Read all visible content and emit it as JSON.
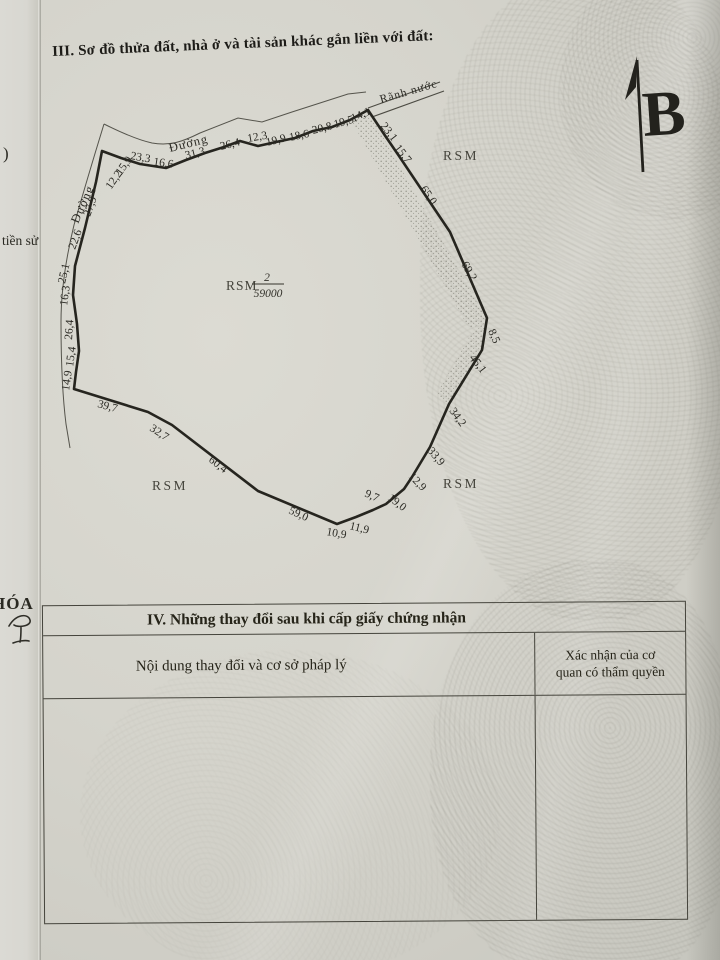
{
  "colors": {
    "paper": "#d5d4cc",
    "ink": "#23221d"
  },
  "section3": {
    "title": "III. Sơ đồ thửa đất, nhà ở và tài sản khác gắn liền với đất:"
  },
  "margin": {
    "fragment_top": ")",
    "fragment_mid": "tiền sử",
    "fragment_bottom": "HÓA"
  },
  "diagram": {
    "north_label": "B",
    "top_road_label": "Đường",
    "left_road_label": "Đường",
    "ditch_label": "Rãnh nước",
    "parcel": {
      "code": "RSM",
      "numerator": "2",
      "denominator": "59000"
    },
    "adjacent_labels": {
      "top_right": "RSM",
      "bottom_left": "RSM",
      "bottom_right": "RSM"
    },
    "measurements": {
      "top": [
        "12,2",
        "15,9",
        "23,3",
        "16,6",
        "31,3",
        "26,4",
        "12,3",
        "19,9",
        "18,6",
        "20,8",
        "19,5",
        "14,1"
      ],
      "right": [
        "23,1",
        "15,7",
        "65,0",
        "69,2",
        "8,5",
        "45,1"
      ],
      "bottom_right": [
        "34,2",
        "33,9",
        "12,9",
        "19,0",
        "9,7",
        "11,9",
        "10,9"
      ],
      "bottom_left": [
        "59,0",
        "60,4",
        "32,7",
        "39,7"
      ],
      "left": [
        "14,9",
        "15,4",
        "26,4",
        "16,3",
        "25,1",
        "22,6",
        "27,9"
      ]
    }
  },
  "table": {
    "title": "IV. Những thay đổi sau khi cấp giấy chứng nhận",
    "left_header": "Nội dung thay đổi và cơ sở pháp lý",
    "right_header_line1": "Xác nhận của cơ",
    "right_header_line2": "quan có thẩm quyền"
  }
}
